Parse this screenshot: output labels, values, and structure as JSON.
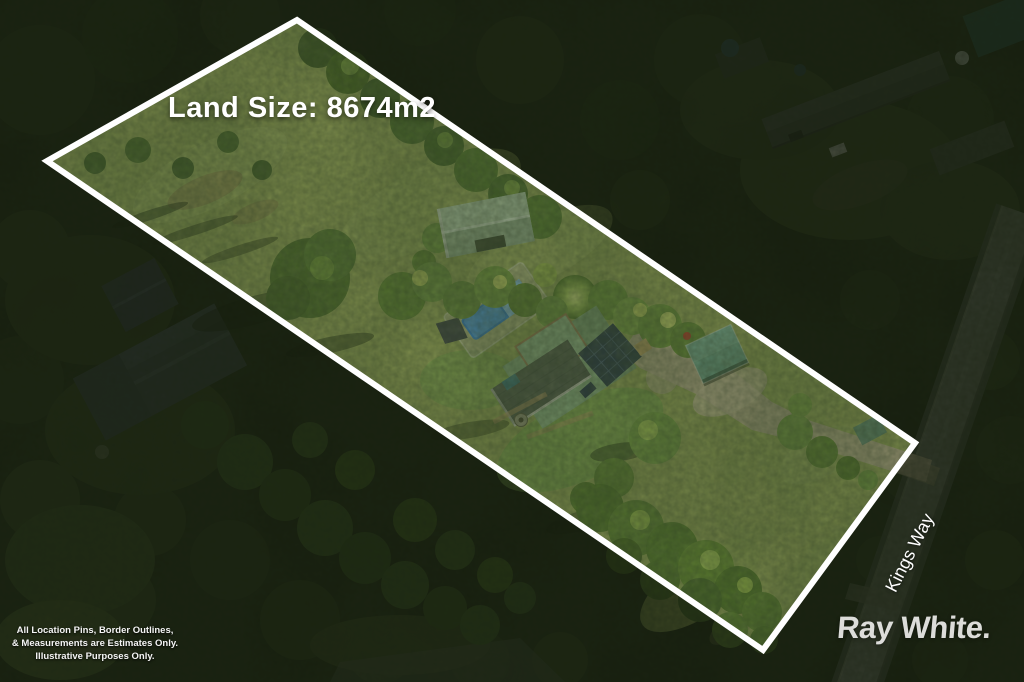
{
  "overlay": {
    "land_size_label": "Land Size: 8674m2",
    "street_label": "Kings Way",
    "brand_label": "Ray White.",
    "disclaimer_lines": [
      "All Location Pins, Border Outlines,",
      "& Measurements are Estimates Only.",
      "Illustrative Purposes Only."
    ]
  },
  "colors": {
    "boundary_stroke": "#ffffff",
    "label_text": "#ffffff",
    "brand_text": "#ebebe9",
    "forest_dark": "#1f2913",
    "lawn_green": "#93a156",
    "pool_water": "#2f7dd1",
    "pool_cover": "#8ec3ea",
    "house_roof_green": "#85a77f",
    "house_roof_tile": "#4b5349",
    "solar_panel": "#223044",
    "shed_roof": "#a3bd9e",
    "carport_roof": "#649784",
    "driveway_tan": "#b3a78b",
    "road_gray": "#6a6e63"
  },
  "scene": {
    "features": [
      "property-boundary",
      "main-house",
      "swimming-pool",
      "garden-shed",
      "carport",
      "driveway",
      "lawn",
      "tree-canopy",
      "road",
      "neighbor-houses"
    ]
  }
}
